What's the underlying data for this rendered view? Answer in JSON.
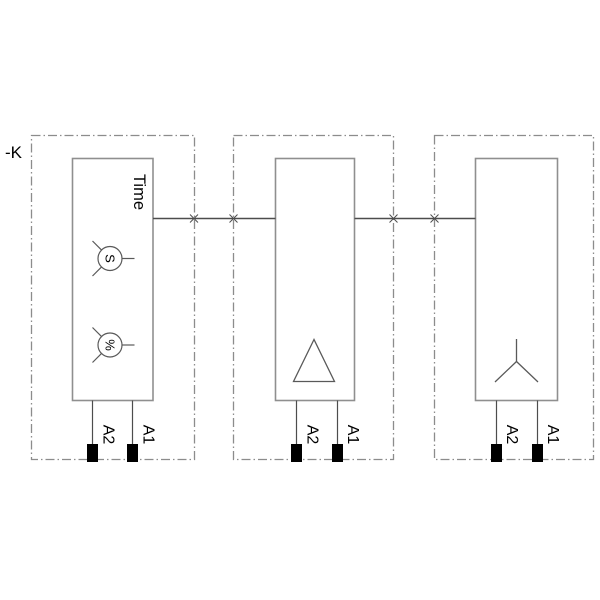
{
  "diagram": {
    "reference_label": "-K",
    "modules": [
      {
        "title": "Time",
        "dials": [
          {
            "label": "S"
          },
          {
            "label": "%"
          }
        ],
        "terminals": [
          {
            "label": "A2"
          },
          {
            "label": "A1"
          }
        ]
      },
      {
        "symbol": "delta-triangle",
        "terminals": [
          {
            "label": "A2"
          },
          {
            "label": "A1"
          }
        ]
      },
      {
        "symbol": "star-wye",
        "terminals": [
          {
            "label": "A2"
          },
          {
            "label": "A1"
          }
        ]
      }
    ]
  },
  "icons": {
    "delta": "delta-triangle-icon",
    "star": "star-wye-icon",
    "dial": "adjustment-dial-icon",
    "cross": "boundary-cross-marker"
  },
  "colors": {
    "background": "#ffffff",
    "enclosure_border": "#8c8c8c",
    "device_border": "#8f8f8f",
    "connection_line": "#4d4d4d",
    "symbol_stroke": "#595959",
    "terminal_fill": "#000000",
    "text": "#000000"
  }
}
